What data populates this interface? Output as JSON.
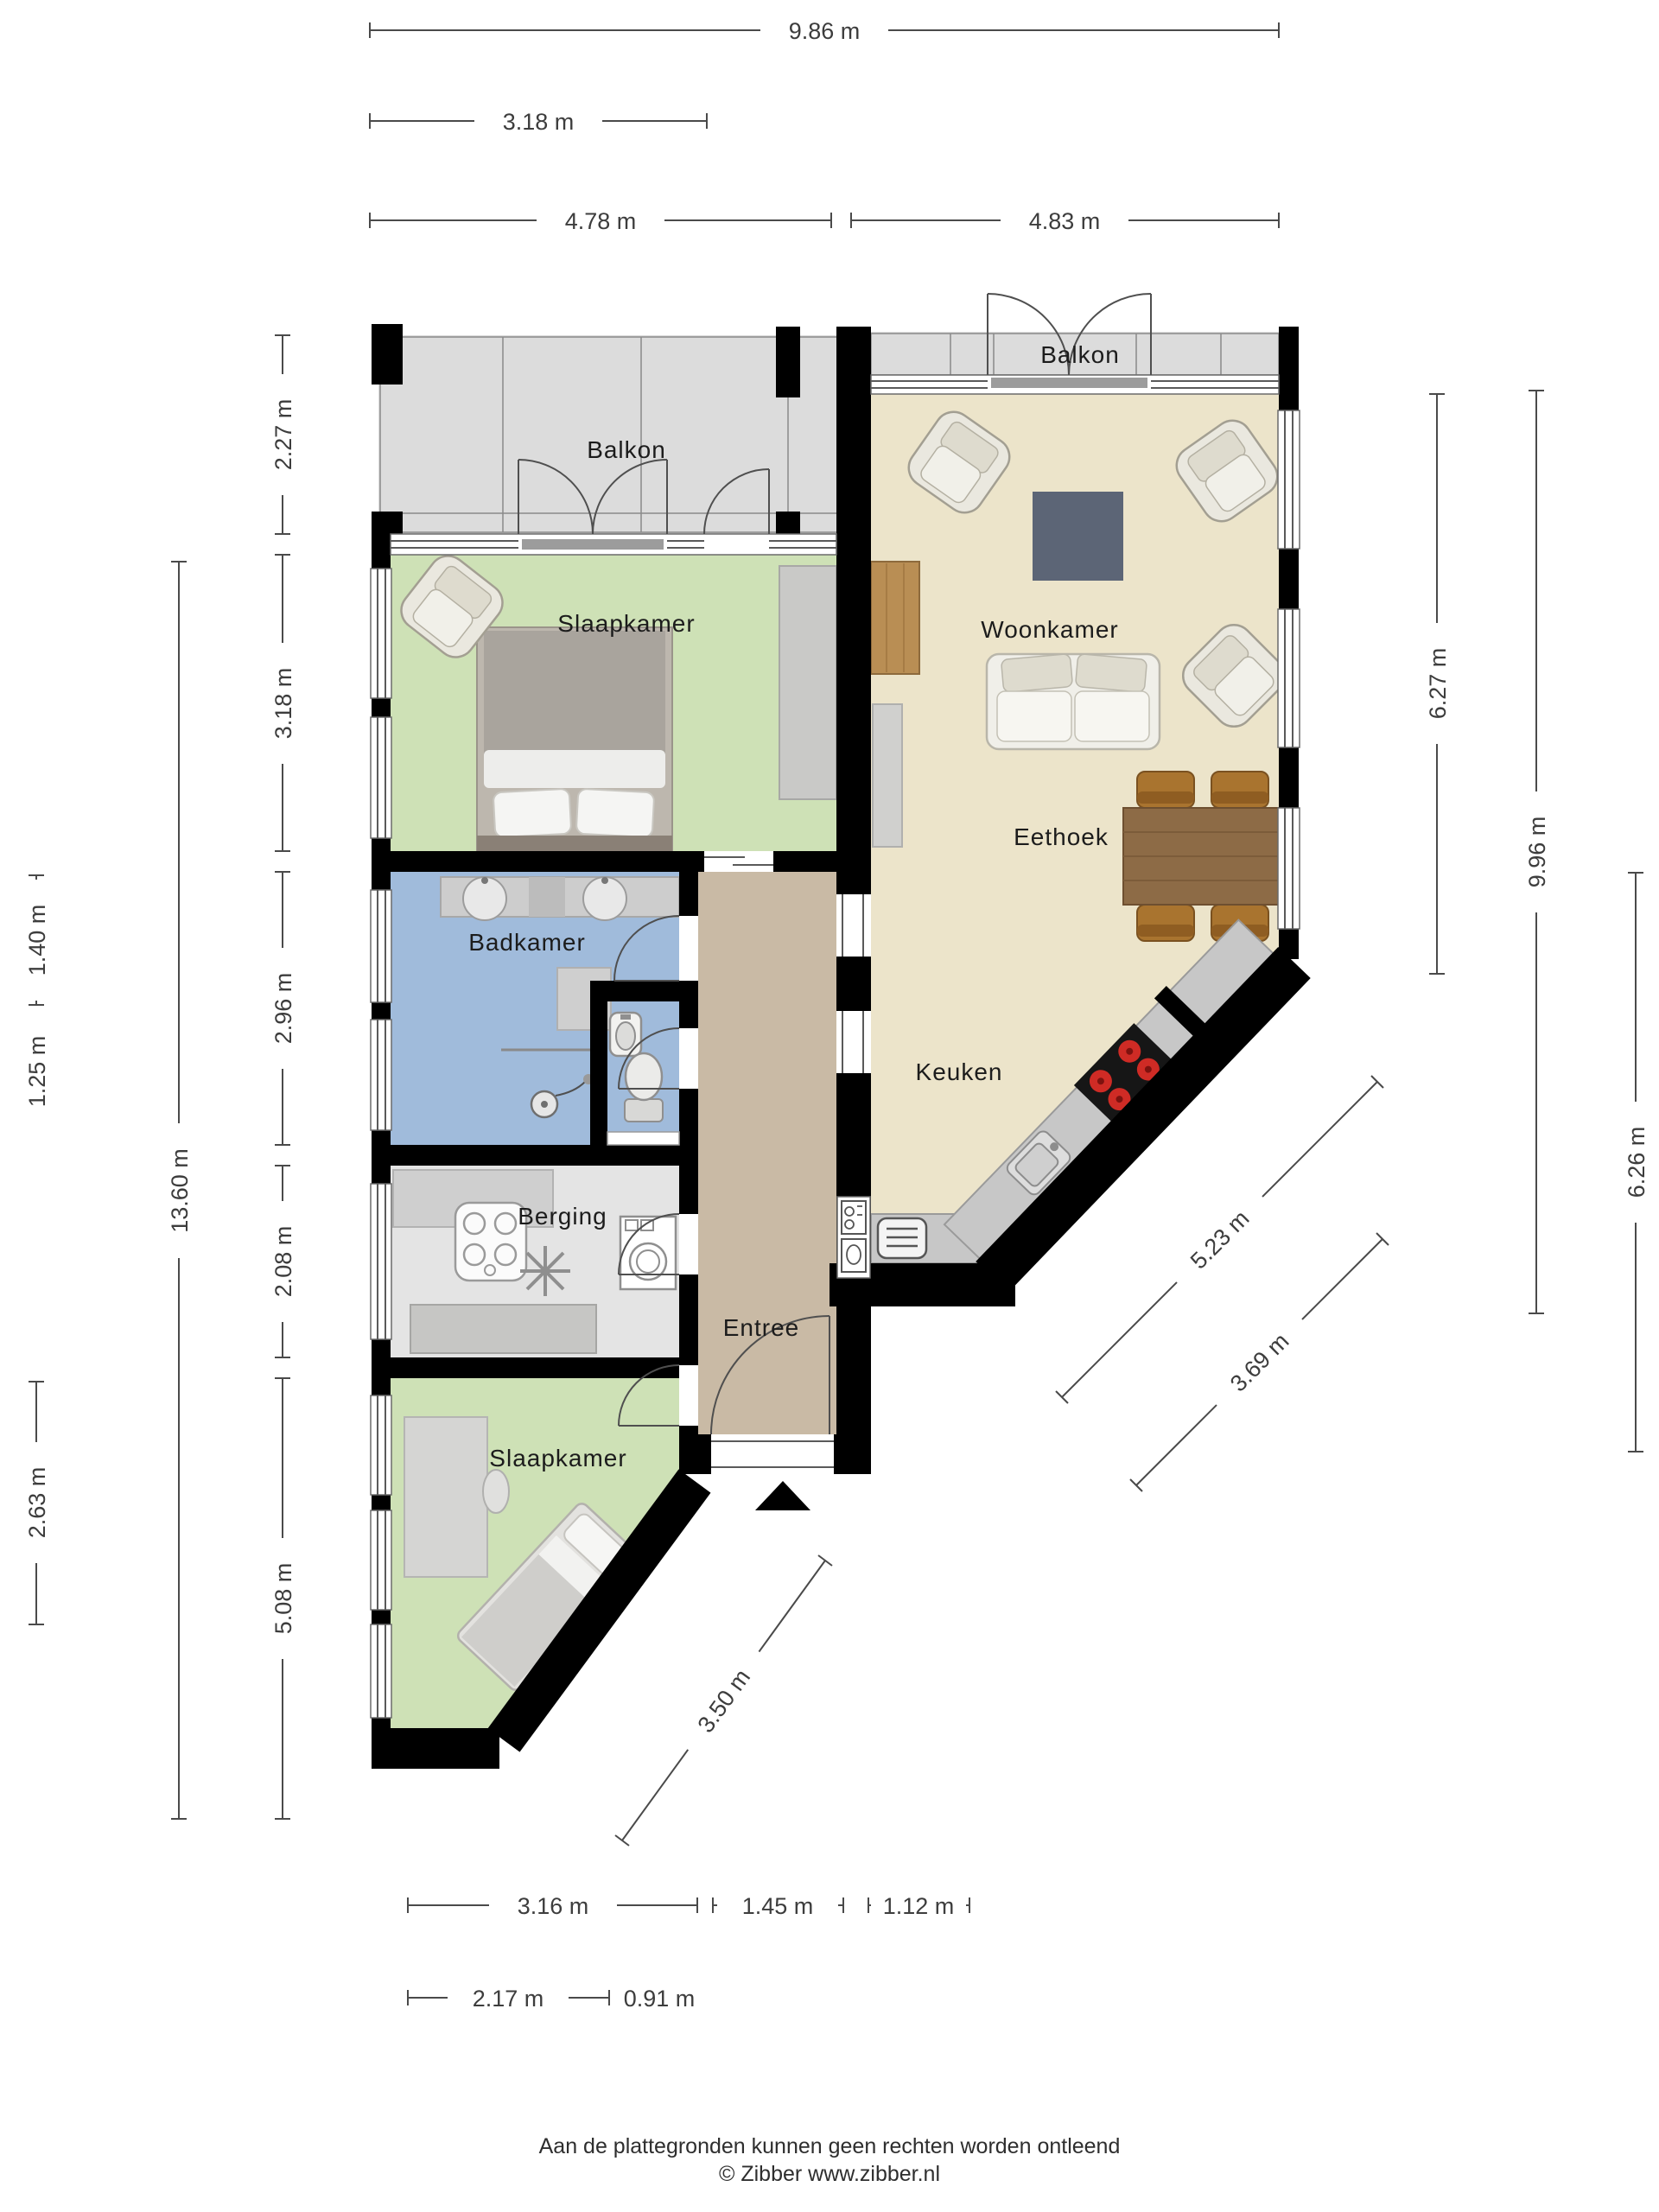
{
  "footer": {
    "disclaimer": "Aan de plattegronden kunnen geen rechten worden ontleend",
    "copyright": "© Zibber www.zibber.nl"
  },
  "rooms": {
    "balkon_left": {
      "label": "Balkon"
    },
    "slaapkamer_top": {
      "label": "Slaapkamer"
    },
    "woonkamer": {
      "label": "Woonkamer"
    },
    "eethoek": {
      "label": "Eethoek"
    },
    "badkamer": {
      "label": "Badkamer"
    },
    "keuken": {
      "label": "Keuken"
    },
    "berging": {
      "label": "Berging"
    },
    "entree": {
      "label": "Entree"
    },
    "slaapkamer_bottom": {
      "label": "Slaapkamer"
    },
    "balkon_right": {
      "label": "Balkon"
    }
  },
  "dimensions": {
    "top": [
      {
        "id": "total-width",
        "label": "9.86 m"
      },
      {
        "id": "balcony-left-width",
        "label": "3.18 m"
      },
      {
        "id": "left-wing-width",
        "label": "4.78 m"
      },
      {
        "id": "right-wing-width",
        "label": "4.83 m"
      }
    ],
    "left": [
      {
        "id": "balcony-depth",
        "label": "2.27 m"
      },
      {
        "id": "bedroom-top-depth",
        "label": "3.18 m"
      },
      {
        "id": "bathroom-depth",
        "label": "2.96 m"
      },
      {
        "id": "storage-depth",
        "label": "2.08 m"
      },
      {
        "id": "bedroom-bottom-depth",
        "label": "5.08 m"
      },
      {
        "id": "total-depth",
        "label": "13.60 m"
      },
      {
        "id": "detail-upper",
        "label": "1.40 m"
      },
      {
        "id": "detail-lower",
        "label": "1.25 m"
      },
      {
        "id": "bedroom-bottom-wall",
        "label": "2.63 m"
      }
    ],
    "right": [
      {
        "id": "living-height",
        "label": "6.27 m"
      },
      {
        "id": "right-total-height",
        "label": "9.96 m"
      },
      {
        "id": "hall-kitchen-height",
        "label": "6.26 m"
      }
    ],
    "diagonal": [
      {
        "id": "kitchen-diagonal-long",
        "label": "5.23 m"
      },
      {
        "id": "kitchen-diagonal-short",
        "label": "3.69 m"
      },
      {
        "id": "bedroom-diagonal",
        "label": "3.50 m"
      }
    ],
    "bottom": [
      {
        "id": "bedroom-bottom-width",
        "label": "3.16 m"
      },
      {
        "id": "hall-width",
        "label": "1.45 m"
      },
      {
        "id": "kitchen-bottom-width",
        "label": "1.12 m"
      },
      {
        "id": "bottom-detail-left",
        "label": "2.17 m"
      },
      {
        "id": "bottom-detail-right",
        "label": "0.91 m"
      }
    ]
  },
  "colors": {
    "wall": "#000000",
    "balcony_floor": "#dcdcdc",
    "bedroom_floor": "#cee1b6",
    "living_floor": "#ece4ca",
    "bath_floor": "#a0bbdb",
    "storage_floor": "#e4e4e4",
    "hall_floor": "#c9baa5",
    "counter": "#c7c7c7",
    "rug": "#5c6576",
    "wood": "#8d6b46",
    "dim_line": "#4a4a4a"
  }
}
